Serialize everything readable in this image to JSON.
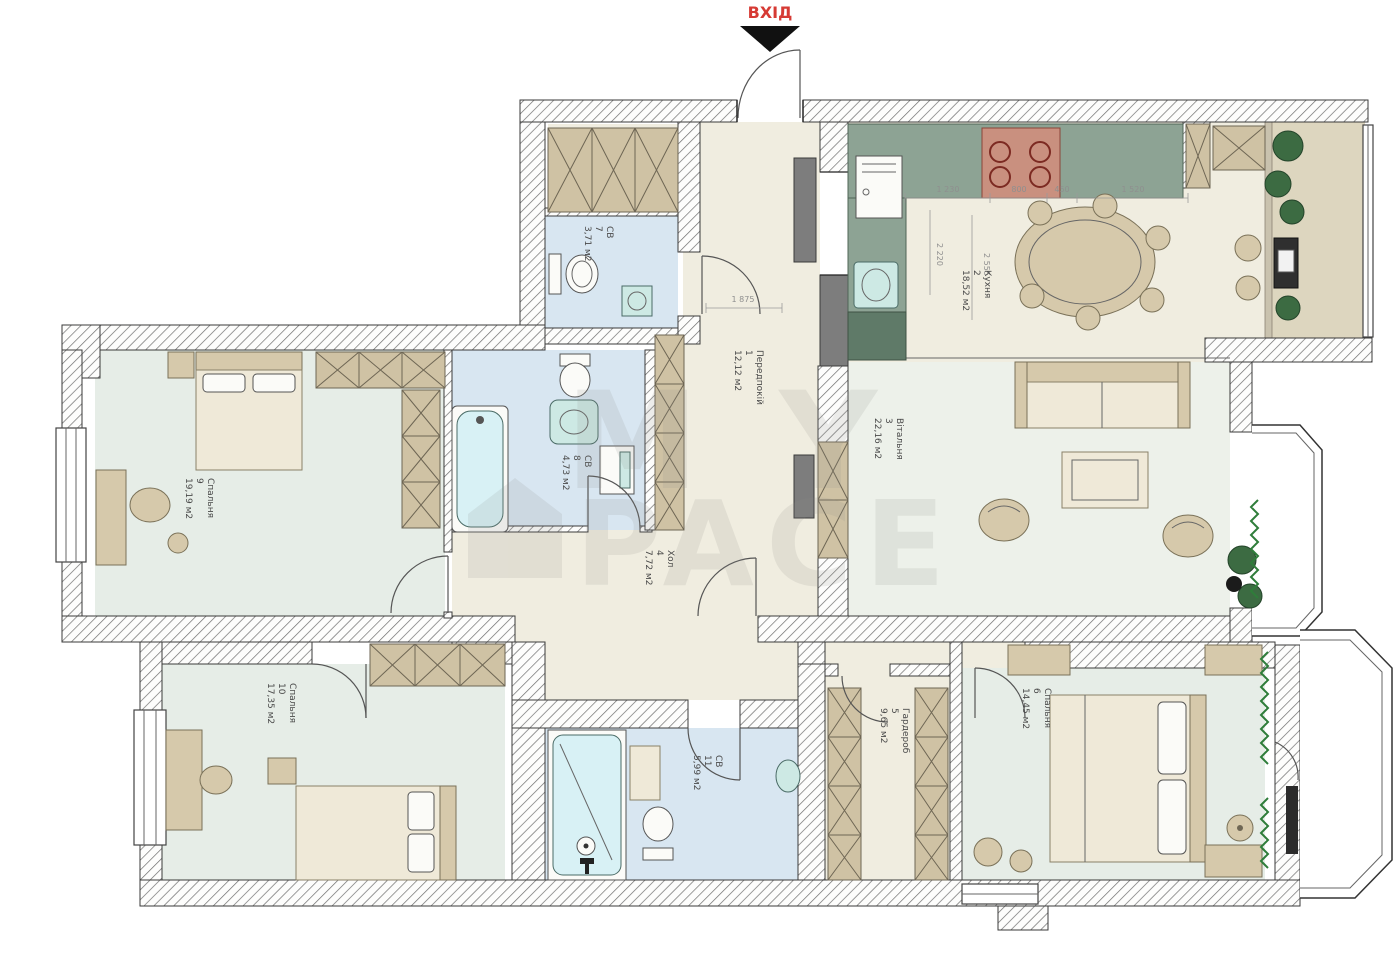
{
  "plan": {
    "entrance_label": "ВХІД",
    "watermark": {
      "line1": "MY",
      "line2": "PACE"
    },
    "rooms": [
      {
        "id": "1",
        "name": "Передпокій",
        "area": "12,12 м2"
      },
      {
        "id": "2",
        "name": "Кухня",
        "area": "18,52 м2"
      },
      {
        "id": "3",
        "name": "Вітальня",
        "area": "22,16 м2"
      },
      {
        "id": "4",
        "name": "Хол",
        "area": "7,72 м2"
      },
      {
        "id": "5",
        "name": "Гардероб",
        "area": "9,65 м2"
      },
      {
        "id": "6",
        "name": "Спальня",
        "area": "14,45 м2"
      },
      {
        "id": "7",
        "name": "СВ",
        "area": "3,71 м2"
      },
      {
        "id": "8",
        "name": "СВ",
        "area": "4,73 м2"
      },
      {
        "id": "9",
        "name": "Спальня",
        "area": "19,19 м2"
      },
      {
        "id": "10",
        "name": "Спальня",
        "area": "17,35 м2"
      },
      {
        "id": "11",
        "name": "СВ",
        "area": "5,99 м2"
      }
    ],
    "dimensions": {
      "hall_width": "1 875",
      "kitchen_segments": [
        "1 230",
        "800",
        "450",
        "1 520"
      ],
      "kitchen_depth_1": "2 220",
      "kitchen_depth_2": "2 555"
    }
  }
}
